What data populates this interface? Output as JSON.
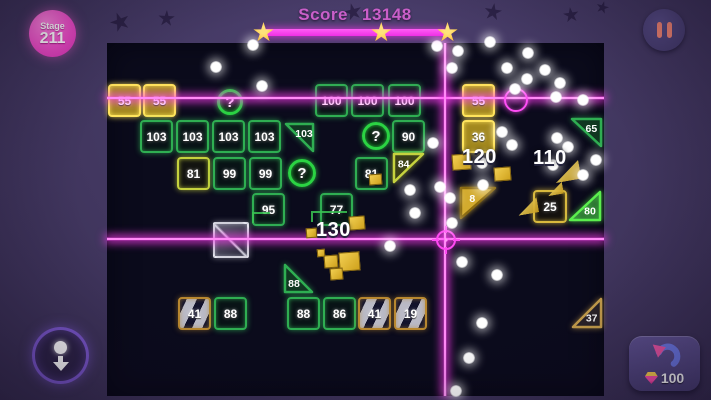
{
  "header": {
    "stage": {
      "label": "Stage",
      "number": "211"
    },
    "score": {
      "label": "Score",
      "value": "13148"
    },
    "progress": {
      "stars": 3,
      "star_positions_pct": [
        0,
        64,
        100
      ],
      "bar_color": "#ee2fe4"
    }
  },
  "hud": {
    "pause": {
      "icon": "pause-icon"
    },
    "pull_down": {
      "icon": "ball-down-icon"
    },
    "undo": {
      "icon": "undo-arrow-icon",
      "gem_icon": "gem-icon",
      "cost": "100"
    }
  },
  "board": {
    "x": 107,
    "y": 43,
    "w": 497,
    "h": 353
  },
  "lasers": {
    "color": "#ff46f2",
    "horizontal_y": [
      98,
      239
    ],
    "vertical_x": [
      445
    ],
    "crosshair": {
      "x": 446,
      "y": 240
    },
    "ring": {
      "x": 514,
      "y": 98
    }
  },
  "bricks": [
    {
      "label": "55",
      "x": 108,
      "y": 84,
      "w": 33,
      "h": 33,
      "shape": "square",
      "style": "gold-solid"
    },
    {
      "label": "55",
      "x": 143,
      "y": 84,
      "w": 33,
      "h": 33,
      "shape": "square",
      "style": "gold-solid"
    },
    {
      "label": "100",
      "x": 315,
      "y": 84,
      "w": 33,
      "h": 33,
      "shape": "square",
      "style": "green"
    },
    {
      "label": "100",
      "x": 351,
      "y": 84,
      "w": 33,
      "h": 33,
      "shape": "square",
      "style": "green"
    },
    {
      "label": "100",
      "x": 388,
      "y": 84,
      "w": 33,
      "h": 33,
      "shape": "square",
      "style": "green"
    },
    {
      "label": "55",
      "x": 462,
      "y": 84,
      "w": 33,
      "h": 33,
      "shape": "square",
      "style": "gold-solid"
    },
    {
      "label": "?",
      "x": 217,
      "y": 89,
      "w": 26,
      "h": 26,
      "shape": "circle",
      "style": "question"
    },
    {
      "label": "103",
      "x": 140,
      "y": 120,
      "w": 33,
      "h": 33,
      "shape": "square",
      "style": "green"
    },
    {
      "label": "103",
      "x": 176,
      "y": 120,
      "w": 33,
      "h": 33,
      "shape": "square",
      "style": "green"
    },
    {
      "label": "103",
      "x": 212,
      "y": 120,
      "w": 33,
      "h": 33,
      "shape": "square",
      "style": "green"
    },
    {
      "label": "103",
      "x": 248,
      "y": 120,
      "w": 33,
      "h": 33,
      "shape": "square",
      "style": "green"
    },
    {
      "label": "103",
      "x": 284,
      "y": 122,
      "w": 31,
      "h": 31,
      "shape": "tri-tr",
      "style": "green"
    },
    {
      "label": "?",
      "x": 362,
      "y": 122,
      "w": 28,
      "h": 28,
      "shape": "circle",
      "style": "question"
    },
    {
      "label": "90",
      "x": 392,
      "y": 120,
      "w": 33,
      "h": 33,
      "shape": "square",
      "style": "green"
    },
    {
      "label": "36",
      "x": 462,
      "y": 120,
      "w": 33,
      "h": 33,
      "shape": "square",
      "style": "gold-solid"
    },
    {
      "label": "65",
      "x": 570,
      "y": 117,
      "w": 33,
      "h": 31,
      "shape": "tri-tr",
      "style": "green"
    },
    {
      "label": "81",
      "x": 177,
      "y": 157,
      "w": 33,
      "h": 33,
      "shape": "square",
      "style": "lime"
    },
    {
      "label": "99",
      "x": 213,
      "y": 157,
      "w": 33,
      "h": 33,
      "shape": "square",
      "style": "green"
    },
    {
      "label": "99",
      "x": 249,
      "y": 157,
      "w": 33,
      "h": 33,
      "shape": "square",
      "style": "green"
    },
    {
      "label": "?",
      "x": 288,
      "y": 159,
      "w": 28,
      "h": 28,
      "shape": "circle",
      "style": "question"
    },
    {
      "label": "81",
      "x": 355,
      "y": 157,
      "w": 33,
      "h": 33,
      "shape": "square",
      "style": "green"
    },
    {
      "label": "84",
      "x": 392,
      "y": 152,
      "w": 33,
      "h": 32,
      "shape": "tri-tl",
      "style": "lime"
    },
    {
      "label": "95",
      "x": 252,
      "y": 193,
      "w": 33,
      "h": 33,
      "shape": "square",
      "style": "green"
    },
    {
      "label": "77",
      "x": 320,
      "y": 193,
      "w": 33,
      "h": 33,
      "shape": "square",
      "style": "green"
    },
    {
      "label": "8",
      "x": 459,
      "y": 186,
      "w": 38,
      "h": 34,
      "shape": "tri-tl",
      "style": "gold-fill"
    },
    {
      "label": "25",
      "x": 533,
      "y": 190,
      "w": 34,
      "h": 33,
      "shape": "square",
      "style": "gold-outline"
    },
    {
      "label": "80",
      "x": 568,
      "y": 190,
      "w": 34,
      "h": 32,
      "shape": "tri-br",
      "style": "green-bright"
    },
    {
      "label": "",
      "x": 213,
      "y": 222,
      "w": 36,
      "h": 36,
      "shape": "square",
      "style": "metal"
    },
    {
      "label": "88",
      "x": 283,
      "y": 263,
      "w": 31,
      "h": 31,
      "shape": "tri-bl",
      "style": "green"
    },
    {
      "label": "41",
      "x": 178,
      "y": 297,
      "w": 33,
      "h": 33,
      "shape": "square",
      "style": "striped"
    },
    {
      "label": "88",
      "x": 214,
      "y": 297,
      "w": 33,
      "h": 33,
      "shape": "square",
      "style": "green"
    },
    {
      "label": "88",
      "x": 287,
      "y": 297,
      "w": 33,
      "h": 33,
      "shape": "square",
      "style": "green"
    },
    {
      "label": "86",
      "x": 323,
      "y": 297,
      "w": 33,
      "h": 33,
      "shape": "square",
      "style": "green"
    },
    {
      "label": "41",
      "x": 358,
      "y": 297,
      "w": 33,
      "h": 33,
      "shape": "square",
      "style": "striped"
    },
    {
      "label": "19",
      "x": 394,
      "y": 297,
      "w": 33,
      "h": 33,
      "shape": "square",
      "style": "striped"
    },
    {
      "label": "37",
      "x": 571,
      "y": 297,
      "w": 32,
      "h": 32,
      "shape": "tri-br",
      "style": "bronze"
    }
  ],
  "floating_values": [
    {
      "text": "120",
      "x": 462,
      "y": 146
    },
    {
      "text": "110",
      "x": 533,
      "y": 147
    },
    {
      "text": "130",
      "x": 316,
      "y": 219
    }
  ],
  "balls": [
    [
      253,
      45
    ],
    [
      216,
      67
    ],
    [
      262,
      86
    ],
    [
      437,
      46
    ],
    [
      458,
      51
    ],
    [
      490,
      42
    ],
    [
      452,
      68
    ],
    [
      528,
      53
    ],
    [
      507,
      68
    ],
    [
      545,
      70
    ],
    [
      527,
      79
    ],
    [
      560,
      83
    ],
    [
      515,
      89
    ],
    [
      556,
      97
    ],
    [
      583,
      100
    ],
    [
      502,
      132
    ],
    [
      512,
      145
    ],
    [
      557,
      138
    ],
    [
      568,
      147
    ],
    [
      433,
      143
    ],
    [
      482,
      163
    ],
    [
      553,
      165
    ],
    [
      583,
      175
    ],
    [
      483,
      185
    ],
    [
      440,
      187
    ],
    [
      410,
      190
    ],
    [
      450,
      198
    ],
    [
      415,
      213
    ],
    [
      452,
      223
    ],
    [
      390,
      246
    ],
    [
      462,
      262
    ],
    [
      497,
      275
    ],
    [
      482,
      323
    ],
    [
      469,
      358
    ],
    [
      456,
      391
    ],
    [
      596,
      160
    ]
  ],
  "gold_debris": [
    [
      452,
      154,
      17,
      14
    ],
    [
      494,
      167,
      15,
      12
    ],
    [
      306,
      228,
      9,
      8
    ],
    [
      349,
      216,
      14,
      12
    ],
    [
      339,
      252,
      19,
      17
    ],
    [
      324,
      255,
      12,
      11
    ],
    [
      330,
      268,
      11,
      10
    ],
    [
      317,
      249,
      6,
      6
    ],
    [
      369,
      174,
      11,
      9
    ]
  ],
  "arrow_items": [
    [
      554,
      162,
      26,
      19
    ],
    [
      547,
      183,
      16,
      12
    ],
    [
      517,
      199,
      21,
      15
    ]
  ],
  "debris_wires": [
    [
      252,
      212,
      16,
      9
    ],
    [
      311,
      211,
      34,
      9
    ]
  ],
  "bg_stars": [
    [
      110,
      12,
      20
    ],
    [
      158,
      10,
      17
    ],
    [
      344,
      3,
      18
    ],
    [
      484,
      3,
      18
    ],
    [
      563,
      7,
      16
    ],
    [
      596,
      1,
      13
    ]
  ],
  "colors": {
    "background": "#443963",
    "board": "#0b0b1c",
    "laser": "#ff46f2",
    "brick_green": "#2fae52",
    "brick_gold": "#ffe45c",
    "brick_lime": "#c6d23e",
    "brick_bronze": "#c9a14c",
    "score_text": "#c95fc9",
    "star_gold": "#ffc33a",
    "pause_bars": "#ee8270",
    "stage_badge": "#ee4cc7"
  }
}
